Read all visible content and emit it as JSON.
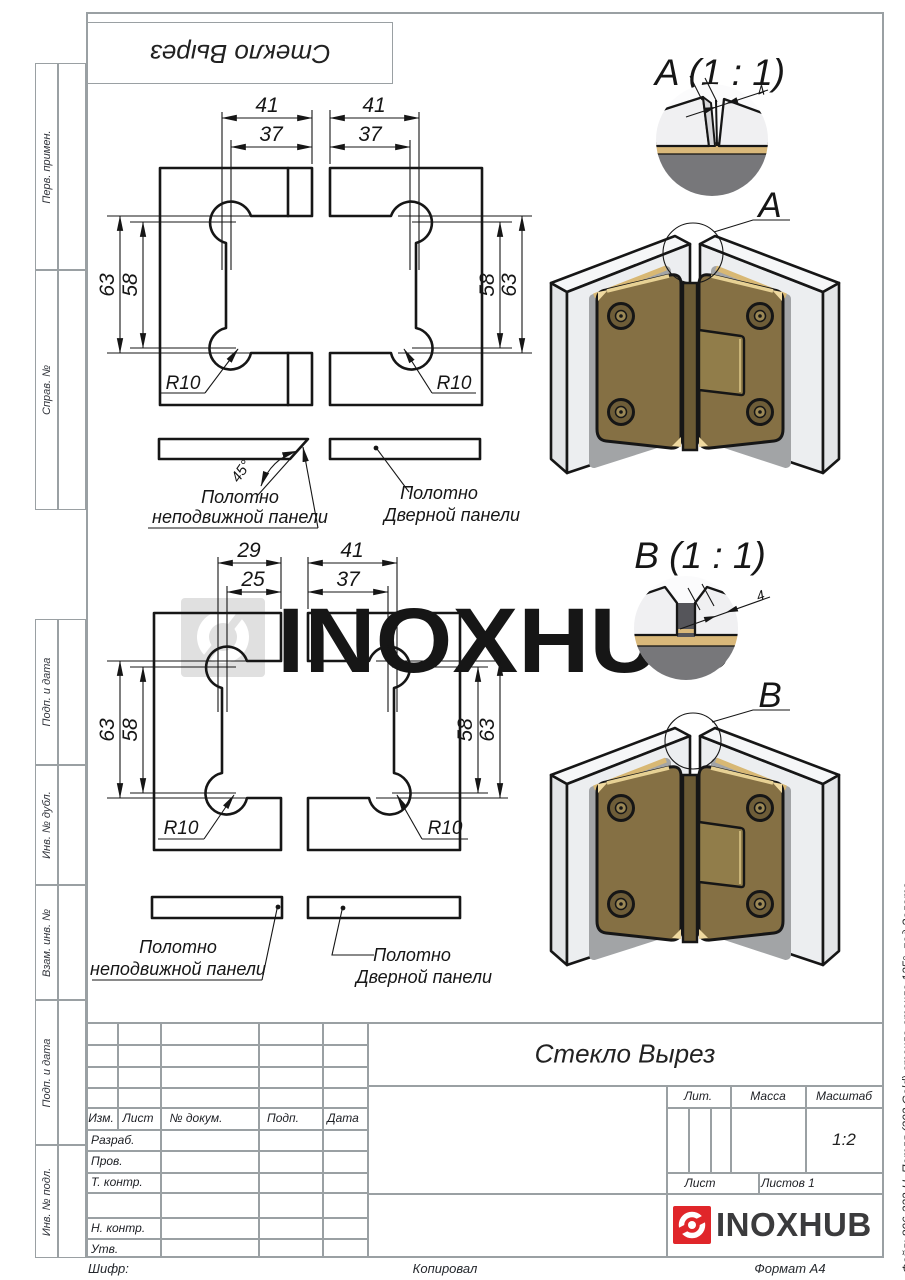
{
  "sheet": {
    "top_stamp": "Стекло Вырез"
  },
  "margins": {
    "m1": "Перв. примен.",
    "m2": "Справ. №",
    "m3": "Подп. и дата",
    "m4": "Инв. № дубл.",
    "m5": "Взам. инв. №",
    "m6": "Подп. и дата",
    "m7": "Инв. № подл."
  },
  "watermark": {
    "text": "INOXHUB"
  },
  "view_top": {
    "dims": {
      "wl1": "41",
      "wl2": "37",
      "wr1": "41",
      "wr2": "37",
      "hl1": "63",
      "hl2": "58",
      "hr1": "58",
      "hr2": "63",
      "rl": "R10",
      "rr": "R10",
      "angle": "45°"
    },
    "labels": {
      "f1": "Полотно",
      "f2": "неподвижной панели",
      "d1": "Полотно",
      "d2": "Дверной панели"
    }
  },
  "view_bottom": {
    "dims": {
      "wl1": "29",
      "wl2": "25",
      "wr1": "41",
      "wr2": "37",
      "hl1": "63",
      "hl2": "58",
      "hr1": "58",
      "hr2": "63",
      "rl": "R10",
      "rr": "R10"
    },
    "labels": {
      "f1": "Полотно",
      "f2": "неподвижной панели",
      "d1": "Полотно",
      "d2": "Дверной панели"
    }
  },
  "detail_a": {
    "title": "A (1 : 1)",
    "dim": "4",
    "callout": "A"
  },
  "detail_b": {
    "title": "B (1 : 1)",
    "dim": "4",
    "callout": "B"
  },
  "title_block": {
    "name": "Стекло Вырез",
    "izm": "Изм.",
    "list_col": "Лист",
    "doc": "№ докум.",
    "podp": "Подп.",
    "date": "Дата",
    "razrab": "Разраб.",
    "prov": "Пров.",
    "t_kontr": "Т. контр.",
    "n_kontr": "Н. контр.",
    "utv": "Утв.",
    "lit": "Лит.",
    "massa": "Масса",
    "scale_label": "Масштаб",
    "scale": "1:2",
    "list": "Лист",
    "listov": "Листов 1"
  },
  "logo": {
    "text": "INOXHUB"
  },
  "footer": {
    "shifr": "Шифр:",
    "kopiroval": "Копировал",
    "format": "Формат A4"
  },
  "side_note": "Файл: 806-332-U_Петля (302 Gold) стекло-стекло 135°, под Золото",
  "colors": {
    "line": "#161616",
    "frame": "#9aa0a3",
    "accent_red": "#e0262a",
    "logo_text": "#3b3b3d",
    "gold": "#857044",
    "gold_light": "#e7d194",
    "gold_band": "#d9b87a",
    "glass": "#eceef0",
    "watermark": "#e0e0e0",
    "detail_dark": "#77777a"
  }
}
